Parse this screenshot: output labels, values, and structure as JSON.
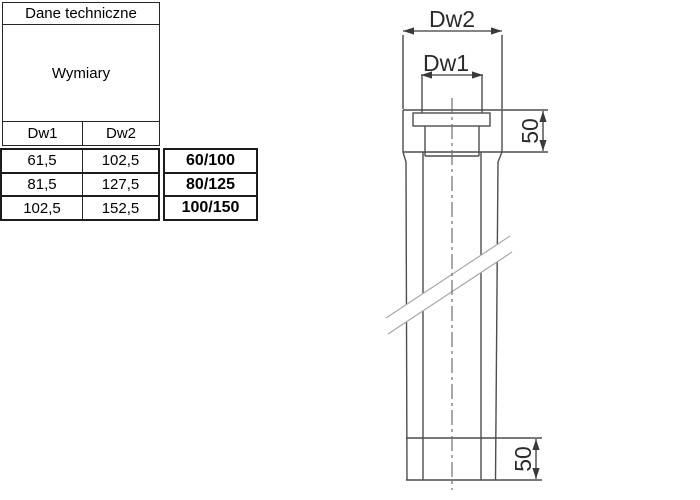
{
  "table": {
    "title": "Dane techniczne",
    "merged_label": "Wymiary",
    "col1": "Dw1",
    "col2": "Dw2",
    "rows": [
      {
        "dw1": "61,5",
        "dw2": "102,5",
        "size": "60/100"
      },
      {
        "dw1": "81,5",
        "dw2": "127,5",
        "size": "80/125"
      },
      {
        "dw1": "102,5",
        "dw2": "152,5",
        "size": "100/150"
      }
    ]
  },
  "drawing": {
    "dim_outer": "Dw2",
    "dim_inner": "Dw1",
    "dim_top_length": "50",
    "dim_bottom_length": "50"
  },
  "colors": {
    "table_border": "#262626",
    "box_border": "#1c1c1c",
    "drawing_line": "#4d4d4d",
    "dimension_line": "#3a3a3a",
    "break_line": "#a8a8a8",
    "centerline": "#6e6e6e",
    "text": "#000000"
  }
}
